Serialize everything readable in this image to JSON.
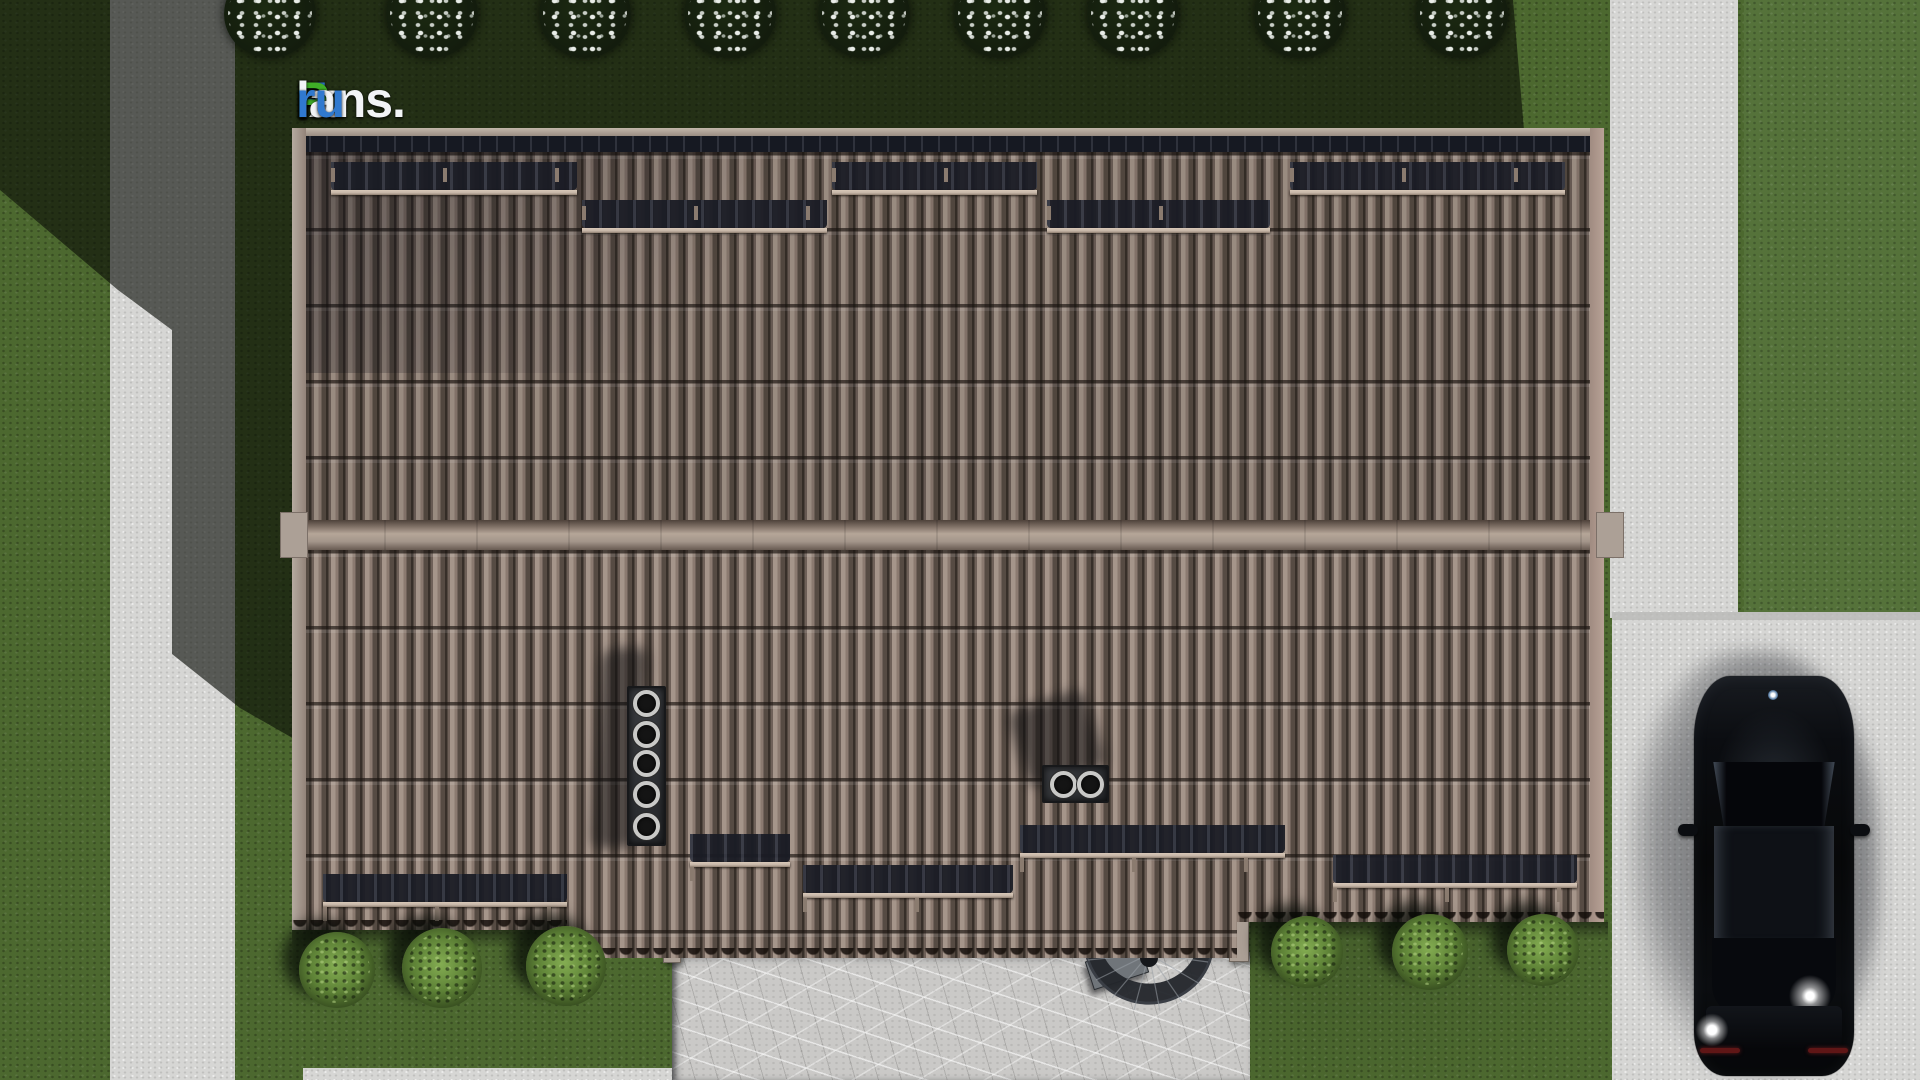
{
  "meta": {
    "description": "Top-down 3D architectural render of a gabled tiled roof house plot with paths, driveway, parked black car, patio with spiral staircase, flowering trees and bushes",
    "canvas": {
      "width": 1920,
      "height": 1080
    }
  },
  "logo": {
    "text": "FixPlans.ru",
    "segments": [
      {
        "text": "F",
        "color": "blue"
      },
      {
        "text": "ix",
        "color": "white"
      },
      {
        "text": "P",
        "color": "green"
      },
      {
        "text": "lans.",
        "color": "white"
      },
      {
        "text": "ru",
        "color": "blue"
      }
    ]
  },
  "palette": {
    "grassLit": "#4c682f",
    "grassBright": "#55723a",
    "concrete": "#d6d6d4",
    "concreteSeam": "#b9b9b7",
    "patio": "#cac9c7",
    "roofBase": "#8b7a70",
    "gutterDark": "#161922",
    "fascia": "#aca096",
    "railColor": "#c4b4a6",
    "railShadowBand": "#1a1c25",
    "pinColor": "#8a7b6f",
    "treeDark": "#131c0d",
    "blossom": "#e9ede8",
    "bushLight": "#84ad52",
    "bushDark": "#273618",
    "logoBlue": "#3079cf",
    "logoGreen": "#3fae27",
    "logoWhite": "#f2f4f6"
  },
  "scene": {
    "trees": {
      "centers_x": [
        270,
        432,
        585,
        730,
        864,
        1000,
        1133,
        1300,
        1462
      ],
      "top": -30
    },
    "bushes": [
      {
        "x": 337,
        "y": 970,
        "r": 38
      },
      {
        "x": 442,
        "y": 968,
        "r": 40
      },
      {
        "x": 566,
        "y": 966,
        "r": 40
      },
      {
        "x": 1307,
        "y": 952,
        "r": 36
      },
      {
        "x": 1430,
        "y": 952,
        "r": 38
      },
      {
        "x": 1543,
        "y": 950,
        "r": 36
      }
    ],
    "roof": {
      "snow_rails_top": [
        {
          "x1": 331,
          "x2": 577,
          "y": 190
        },
        {
          "x1": 582,
          "x2": 827,
          "y": 228
        },
        {
          "x1": 832,
          "x2": 1037,
          "y": 190
        },
        {
          "x1": 1047,
          "x2": 1270,
          "y": 228
        },
        {
          "x1": 1290,
          "x2": 1565,
          "y": 190
        }
      ],
      "snow_rails_bottom": [
        {
          "x1": 323,
          "x2": 567,
          "y": 902
        },
        {
          "x1": 690,
          "x2": 790,
          "y": 862
        },
        {
          "x1": 803,
          "x2": 1013,
          "y": 893
        },
        {
          "x1": 1020,
          "x2": 1285,
          "y": 853
        },
        {
          "x1": 1333,
          "x2": 1577,
          "y": 883
        }
      ],
      "step_edges": [
        {
          "x": 567,
          "y1": 930,
          "y2": 958
        },
        {
          "x": 1237,
          "y1": 922,
          "y2": 958
        }
      ]
    },
    "eave_shadows": [
      {
        "x": 292,
        "y": 930,
        "w": 380,
        "h": 18
      },
      {
        "x": 1250,
        "y": 922,
        "w": 358,
        "h": 18
      }
    ],
    "chimneys": {
      "vent_stack_1": {
        "x": 627,
        "y": 686,
        "w": 39,
        "h": 160,
        "flue_cx": 646,
        "flue_cys": [
          703,
          734,
          763,
          794,
          826
        ]
      },
      "vent_stack_2": {
        "x": 1042,
        "y": 765,
        "w": 67,
        "h": 38,
        "flue_cy": 784,
        "flue_cxs": [
          1063,
          1090
        ]
      }
    },
    "car": {
      "type": "black sedan, top view, parked on driveway",
      "taillights": [
        {
          "left": 6,
          "top": 372,
          "w": 40
        },
        {
          "left": 114,
          "top": 372,
          "w": 40
        }
      ],
      "mirrors": [
        {
          "left": -16,
          "top": 148
        },
        {
          "left": 156,
          "top": 148
        }
      ]
    }
  }
}
